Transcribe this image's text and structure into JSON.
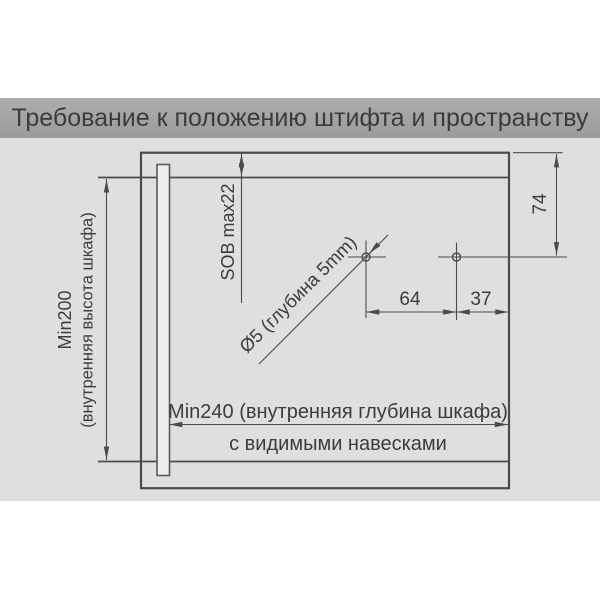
{
  "title": "Требование к положению штифта и пространству",
  "diagram": {
    "labels": {
      "height_min": "Min200",
      "height_note": "(внутренняя высота шкафа)",
      "top_clearance": "SOB max22",
      "hole_spec": "Ø5 (глубина 5mm)",
      "dist_between_holes": "64",
      "dist_hole_to_wall": "37",
      "dist_top_to_holes": "74",
      "depth_min": "Min240 (внутренняя глубина шкафа)",
      "depth_note": "с видимыми навесками"
    },
    "colors": {
      "titlebar_bg": "#a5a5a5",
      "title_text": "#3b3b3b",
      "drawing_bg": "#dfdfdf",
      "line": "#4b4b4b",
      "label_text": "#3c3c3c",
      "panel_fill": "#eeeeee",
      "page_bg": "#ffffff"
    }
  }
}
